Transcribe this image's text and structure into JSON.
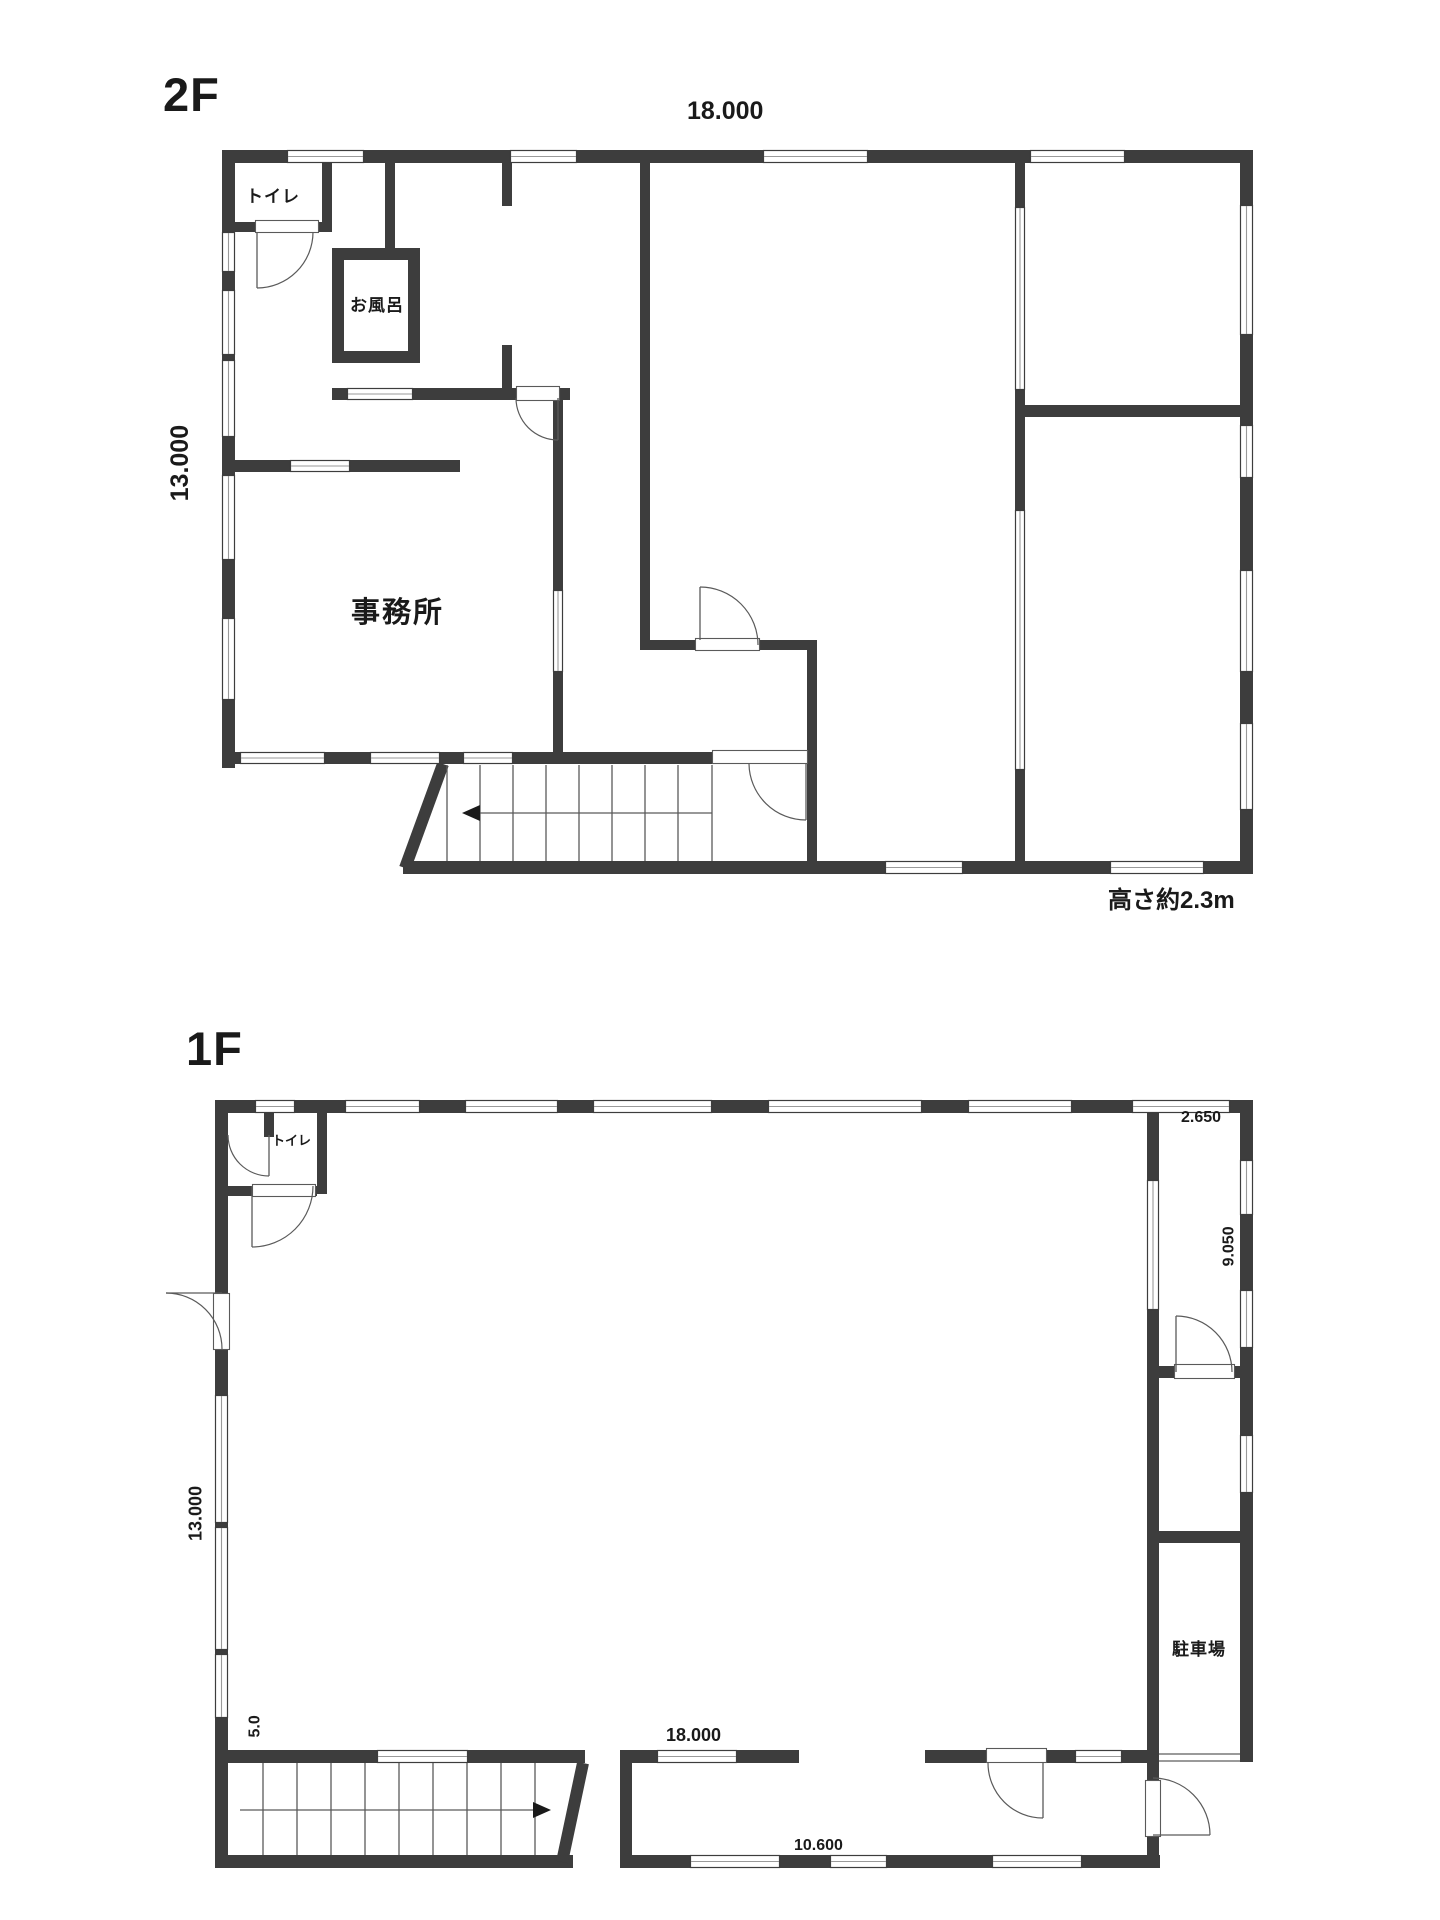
{
  "colors": {
    "wall": "#3d3d3d",
    "thin": "#5a5a5a",
    "window_mid": "#9a9a9a",
    "arrow": "#1a1a1a"
  },
  "floors": [
    {
      "id": "2f",
      "title": "2F",
      "dimensions": {
        "width": "18.000",
        "height": "13.000"
      },
      "labels": {
        "toilet": "トイレ",
        "bath": "お風呂",
        "office": "事務所"
      },
      "note": "高さ約2.3m"
    },
    {
      "id": "1f",
      "title": "1F",
      "dimensions": {
        "width": "18.000",
        "height": "13.000",
        "right_top": "2.650",
        "right_side": "9.050",
        "left_bottom": "5.0",
        "bottom_inner": "10.600"
      },
      "labels": {
        "toilet": "トイレ",
        "parking": "駐車場"
      }
    }
  ]
}
